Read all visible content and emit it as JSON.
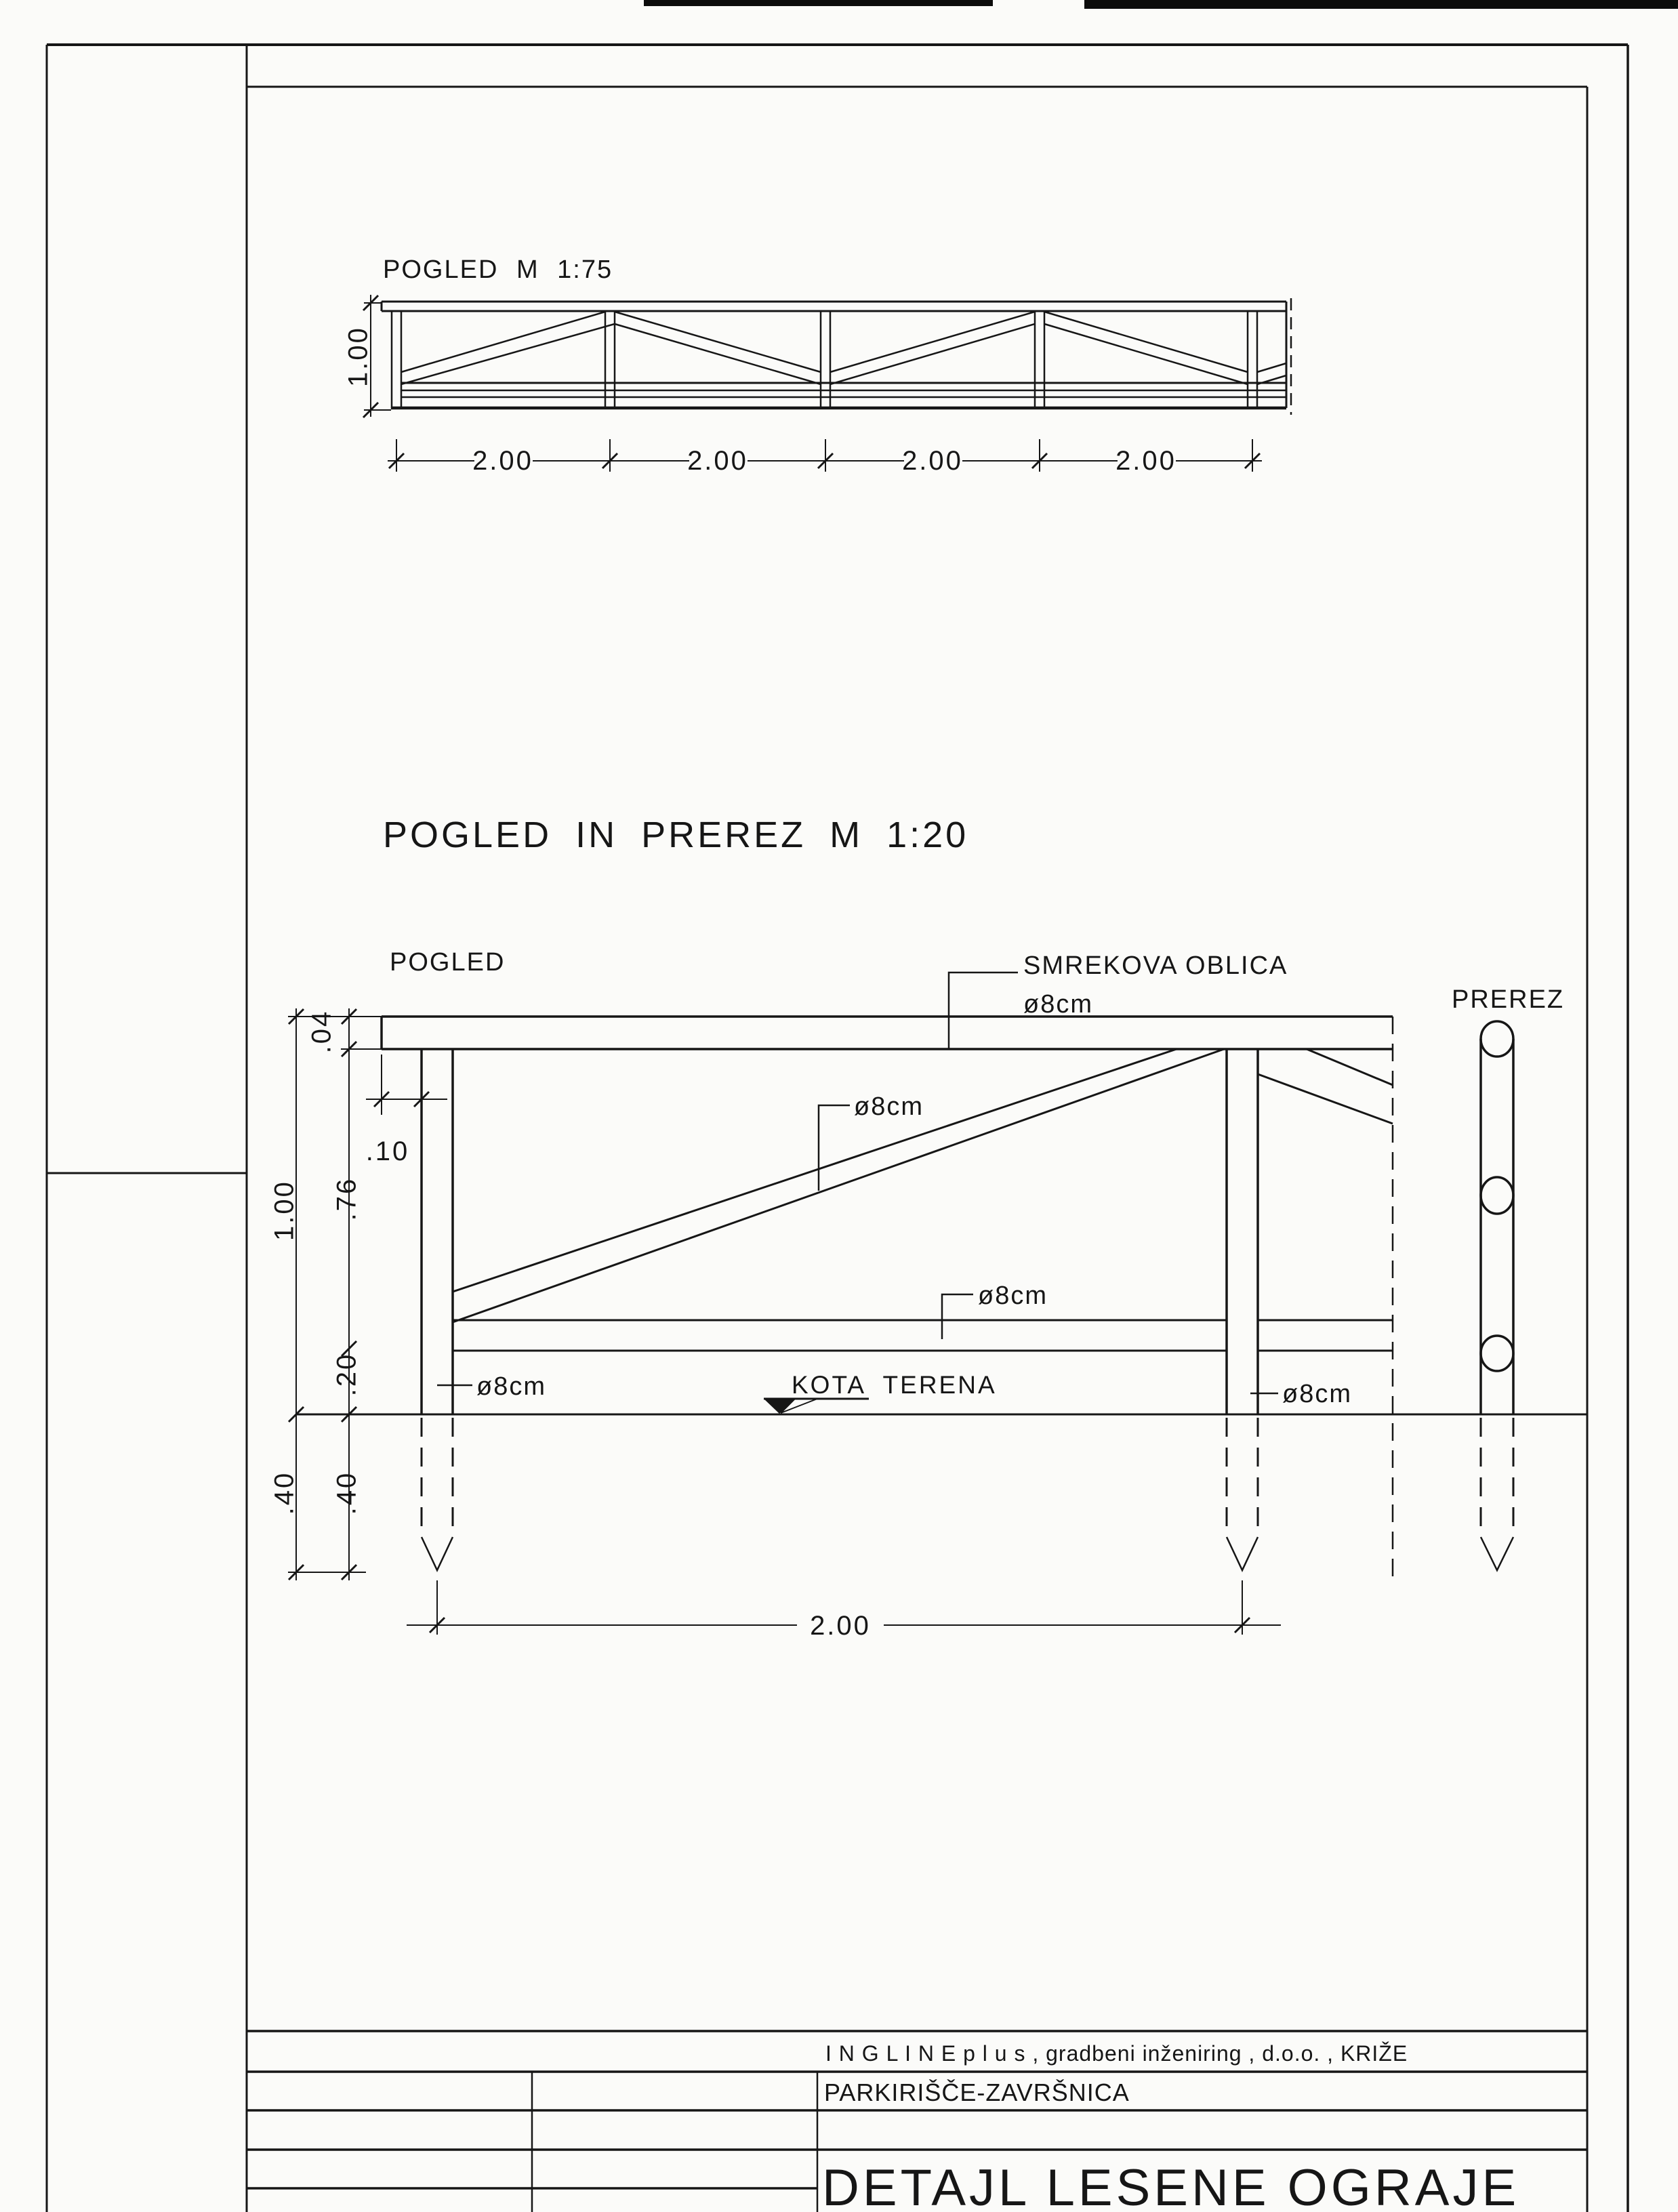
{
  "sheet": {
    "background_color": "#fbfbf9",
    "ink_color": "#161616"
  },
  "top_view": {
    "title": "POGLED M 1:75",
    "height_dim": "1.00",
    "span_dims": [
      "2.00",
      "2.00",
      "2.00",
      "2.00"
    ]
  },
  "detail_view": {
    "title": "POGLED IN PREREZ M 1:20",
    "pogled_label": "POGLED",
    "prerez_label": "PREREZ",
    "material_name": "SMREKOVA OBLICA",
    "material_diameter": "ø8cm",
    "diagonal_diameter": "ø8cm",
    "lower_rail_diameter": "ø8cm",
    "left_post_diameter": "ø8cm",
    "right_post_diameter": "ø8cm",
    "ground_label": "KOTA TERENA",
    "dim_plank_thickness": ".04",
    "dim_post_offset": ".10",
    "dim_upper_height": ".76",
    "dim_total_height": "1.00",
    "dim_lower_gap": ".20",
    "dim_embed_depth_outer": ".40",
    "dim_embed_depth_inner": ".40",
    "dim_post_spacing": "2.00"
  },
  "title_block": {
    "company": "I N G L I N E   p l u s ,  gradbeni inženiring ,  d.o.o. ,  KRIŽE",
    "project": "PARKIRIŠČE-ZAVRŠNICA",
    "drawing_title": "DETAJL LESENE OGRAJE"
  }
}
